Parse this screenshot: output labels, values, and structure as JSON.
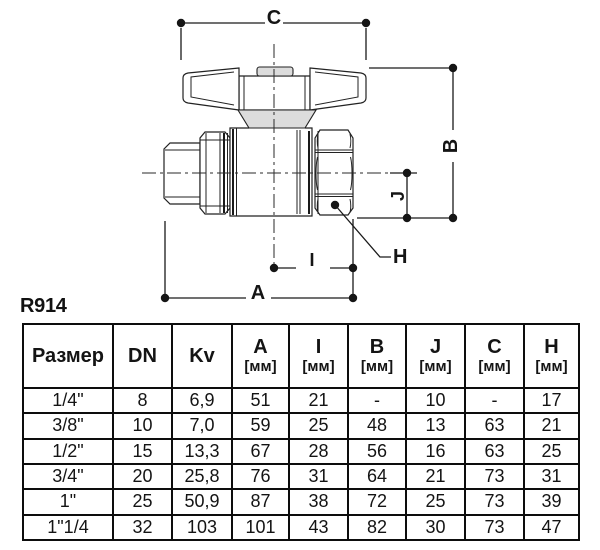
{
  "product_code": "R914",
  "diagram": {
    "labels": {
      "C": "C",
      "B": "B",
      "J": "J",
      "H": "H",
      "I": "I",
      "A": "A"
    },
    "line_color": "#1a1a1a",
    "fill_light": "#dcdcdc"
  },
  "table": {
    "columns": [
      {
        "label": "Размер",
        "unit": ""
      },
      {
        "label": "DN",
        "unit": ""
      },
      {
        "label": "Kv",
        "unit": ""
      },
      {
        "label": "A",
        "unit": "[мм]"
      },
      {
        "label": "I",
        "unit": "[мм]"
      },
      {
        "label": "B",
        "unit": "[мм]"
      },
      {
        "label": "J",
        "unit": "[мм]"
      },
      {
        "label": "C",
        "unit": "[мм]"
      },
      {
        "label": "H",
        "unit": "[мм]"
      }
    ],
    "rows": [
      [
        "1/4\"",
        "8",
        "6,9",
        "51",
        "21",
        "-",
        "10",
        "-",
        "17"
      ],
      [
        "3/8\"",
        "10",
        "7,0",
        "59",
        "25",
        "48",
        "13",
        "63",
        "21"
      ],
      [
        "1/2\"",
        "15",
        "13,3",
        "67",
        "28",
        "56",
        "16",
        "63",
        "25"
      ],
      [
        "3/4\"",
        "20",
        "25,8",
        "76",
        "31",
        "64",
        "21",
        "73",
        "31"
      ],
      [
        "1\"",
        "25",
        "50,9",
        "87",
        "38",
        "72",
        "25",
        "73",
        "39"
      ],
      [
        "1\"1/4",
        "32",
        "103",
        "101",
        "43",
        "82",
        "30",
        "73",
        "47"
      ]
    ]
  }
}
